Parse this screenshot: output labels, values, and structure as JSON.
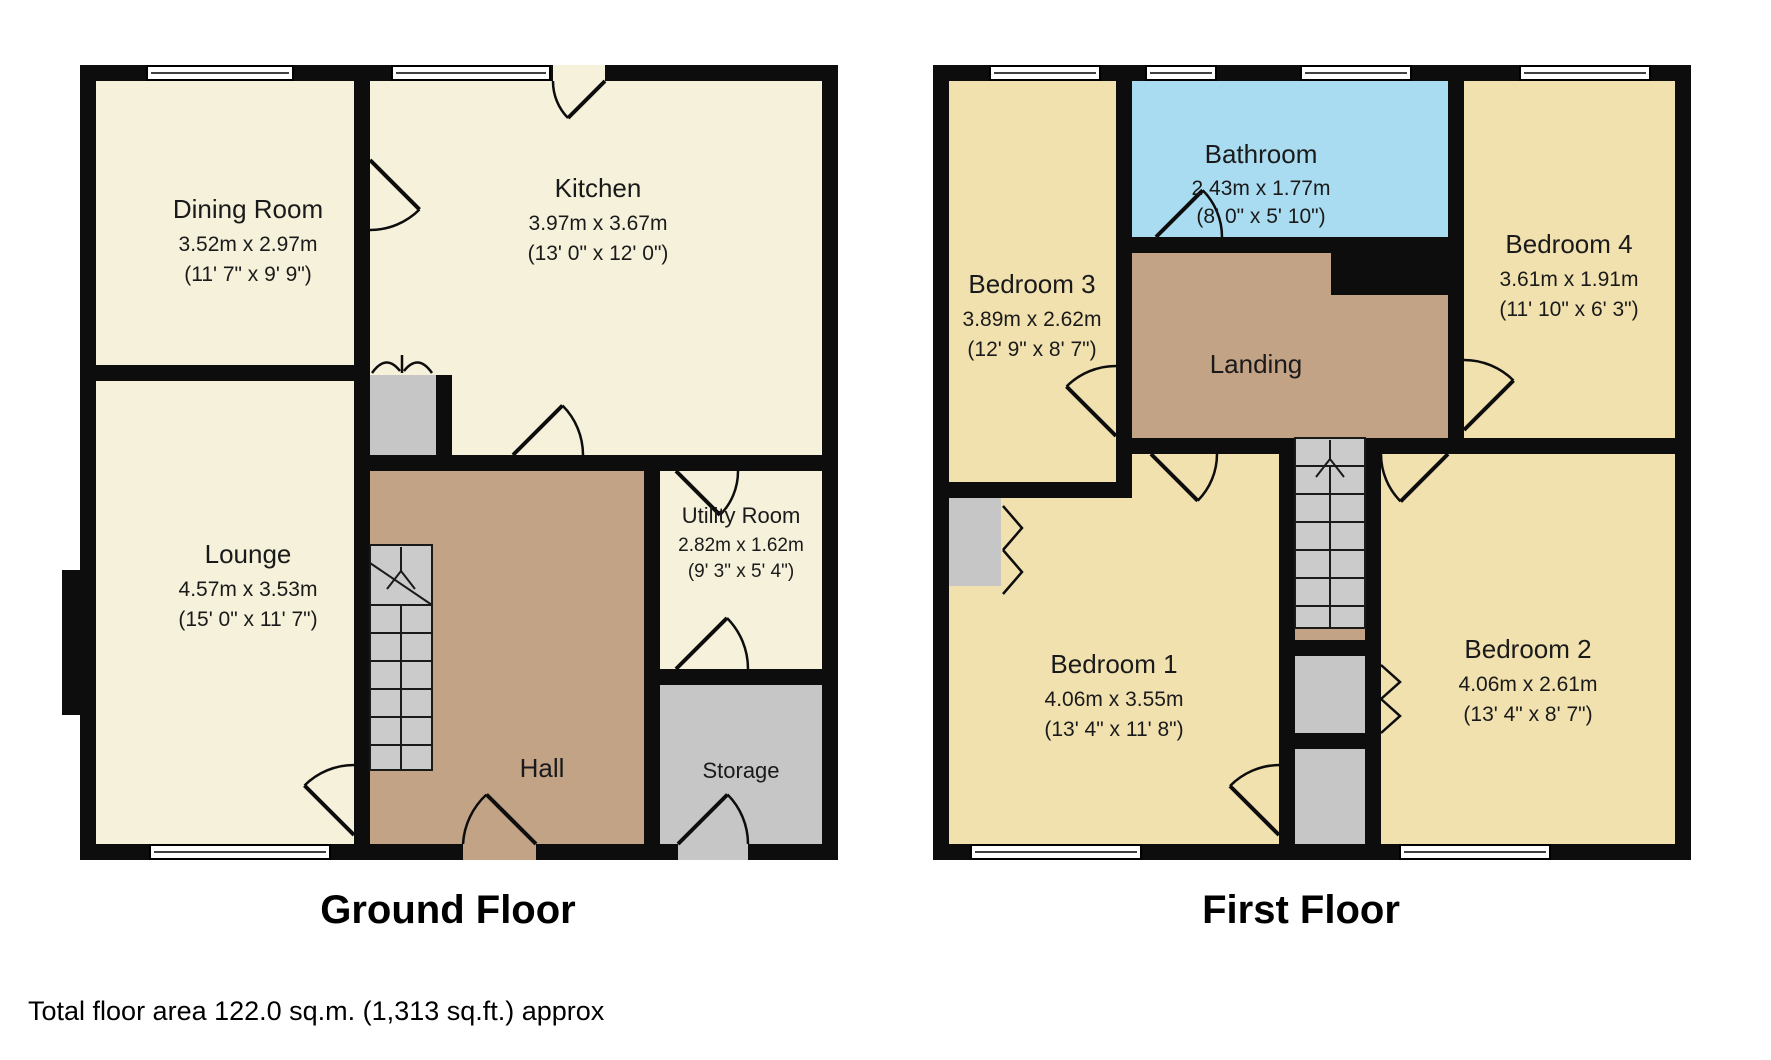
{
  "ground": {
    "caption": "Ground Floor",
    "rooms": {
      "dining": {
        "name": "Dining Room",
        "metric": "3.52m x 2.97m",
        "imperial": "(11' 7\" x 9' 9\")"
      },
      "kitchen": {
        "name": "Kitchen",
        "metric": "3.97m x 3.67m",
        "imperial": "(13' 0\" x 12' 0\")"
      },
      "lounge": {
        "name": "Lounge",
        "metric": "4.57m x 3.53m",
        "imperial": "(15' 0\" x 11' 7\")"
      },
      "hall": {
        "name": "Hall"
      },
      "utility": {
        "name": "Utility Room",
        "metric": "2.82m x 1.62m",
        "imperial": "(9' 3\" x 5' 4\")"
      },
      "storage": {
        "name": "Storage"
      }
    }
  },
  "first": {
    "caption": "First Floor",
    "rooms": {
      "bedroom3": {
        "name": "Bedroom 3",
        "metric": "3.89m x 2.62m",
        "imperial": "(12' 9\" x 8' 7\")"
      },
      "bathroom": {
        "name": "Bathroom",
        "metric": "2.43m x 1.77m",
        "imperial": "(8' 0\" x 5' 10\")"
      },
      "bedroom4": {
        "name": "Bedroom 4",
        "metric": "3.61m x 1.91m",
        "imperial": "(11' 10\" x 6' 3\")"
      },
      "landing": {
        "name": "Landing"
      },
      "bedroom1": {
        "name": "Bedroom 1",
        "metric": "4.06m x 3.55m",
        "imperial": "(13' 4\" x 11' 8\")"
      },
      "bedroom2": {
        "name": "Bedroom 2",
        "metric": "4.06m x 2.61m",
        "imperial": "(13' 4\" x 8' 7\")"
      }
    }
  },
  "footer": {
    "text": "Total floor area 122.0 sq.m. (1,313 sq.ft.) approx"
  },
  "colors": {
    "wall": "#0d0d0d",
    "ground_room": "#f5f1da",
    "bedroom": "#f1e1af",
    "bathroom": "#a9dcf1",
    "hall_landing": "#c3a386",
    "storage_stairs": "#c6c6c6",
    "window": "#ffffff",
    "background": "#ffffff"
  }
}
